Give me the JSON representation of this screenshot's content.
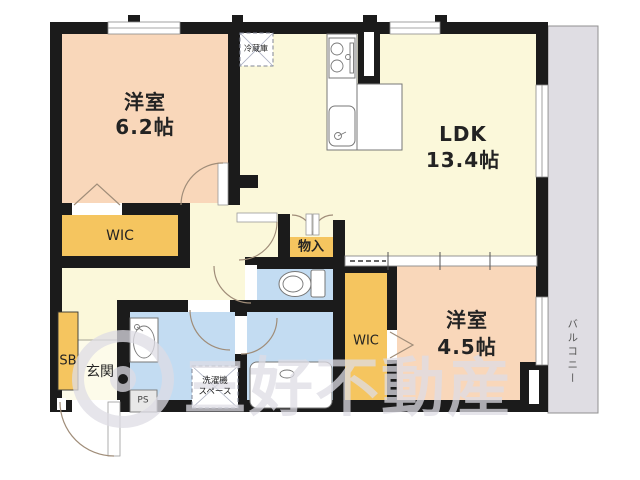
{
  "floorplan": {
    "rooms": {
      "bedroom1": {
        "name": "洋室",
        "size": "6.2帖"
      },
      "ldk": {
        "name": "LDK",
        "size": "13.4帖"
      },
      "bedroom2": {
        "name": "洋室",
        "size": "4.5帖"
      }
    },
    "closets": {
      "wic_left": "WIC",
      "wic_right": "WIC",
      "storage": "物入",
      "shoe_box": "SB"
    },
    "entrance": {
      "label": "玄関"
    },
    "utility": {
      "pipe_space": "PS",
      "refrigerator": "冷蔵庫",
      "washer_line1": "洗濯機",
      "washer_line2": "スペース"
    },
    "balcony": {
      "label": "バルコニー"
    },
    "watermark": {
      "text": "三好不動産"
    },
    "colors": {
      "room_peach": "#F9D7BA",
      "room_cream": "#FBF8DA",
      "genkan_cream": "#FDFBEA",
      "closet_yellow": "#F5C55F",
      "wet_blue": "#C3DCF2",
      "balcony_gray": "#DFDDE3",
      "wall_black": "#1B1B1B",
      "door_arc": "#A08D79"
    }
  }
}
